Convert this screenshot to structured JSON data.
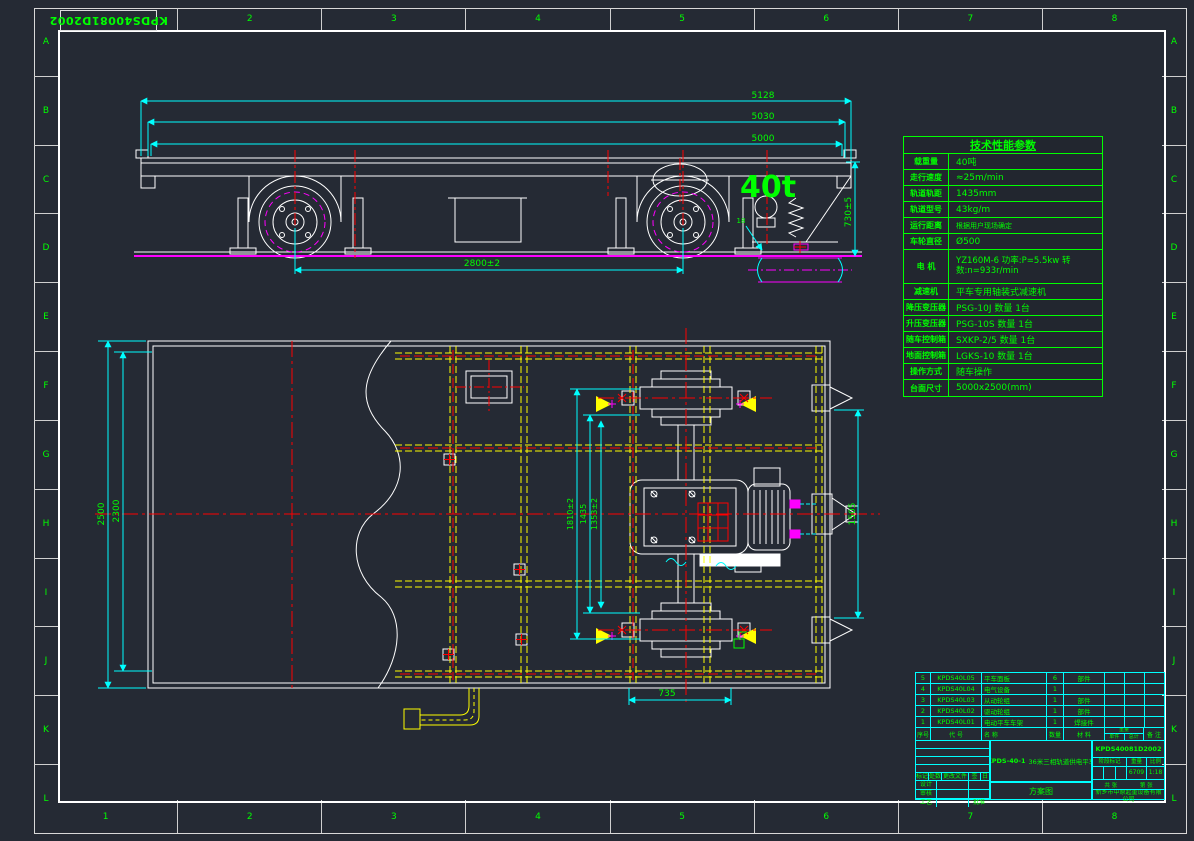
{
  "frame": {
    "corner_code": "KPDS40081D2002",
    "zones_numbers": [
      "1",
      "2",
      "3",
      "4",
      "5",
      "6",
      "7",
      "8"
    ],
    "zones_letters": [
      "A",
      "B",
      "C",
      "D",
      "E",
      "F",
      "G",
      "H",
      "I",
      "J",
      "K",
      "L"
    ]
  },
  "side_view": {
    "load": "40t",
    "dim_total": "5128",
    "dim_mid": "5030",
    "dim_deck": "5000",
    "dim_wheelbase": "2800±2",
    "dim_height": "730±5",
    "dim_rail": "18"
  },
  "plan_view": {
    "dim_width": "2500",
    "dim_width_inner": "2300",
    "dim_outer": "1810±2",
    "dim_gauge": "1435",
    "dim_inner": "1353±2",
    "dim_side": "1505",
    "dim_bottom": "735"
  },
  "tech_table": {
    "title": "技术性能参数",
    "rows": [
      {
        "label": "载重量",
        "value": "40吨"
      },
      {
        "label": "走行速度",
        "value": "≈25m/min"
      },
      {
        "label": "轨道轨距",
        "value": "1435mm"
      },
      {
        "label": "轨道型号",
        "value": "43kg/m"
      },
      {
        "label": "运行距离",
        "value": "根据用户现场确定"
      },
      {
        "label": "车轮直径",
        "value": "Ø500"
      },
      {
        "label": "电  机",
        "value": "YZ160M-6 功率:P=5.5kw 转数:n=933r/min"
      },
      {
        "label": "减速机",
        "value": "平车专用轴装式减速机"
      },
      {
        "label": "降压变压器",
        "value": "PSG-10J  数量 1台"
      },
      {
        "label": "升压变压器",
        "value": "PSG-10S  数量 1台"
      },
      {
        "label": "随车控制箱",
        "value": "SXKP-2/5  数量 1台"
      },
      {
        "label": "地面控制箱",
        "value": "LGKS-10  数量 1台"
      },
      {
        "label": "操作方式",
        "value": "随车操作"
      },
      {
        "label": "台面尺寸",
        "value": "5000x2500(mm)"
      }
    ]
  },
  "bom": {
    "headers": {
      "no": "序号",
      "code": "代 号",
      "name": "名 称",
      "qty": "数量",
      "material": "材 料",
      "weight": "重量",
      "unit": "单件",
      "total": "总计",
      "note": "备 注"
    },
    "rows": [
      {
        "no": "5",
        "code": "KPDS40L05",
        "name": "平车面板",
        "qty": "6",
        "material": "部件",
        "w1": "",
        "w2": "",
        "note": ""
      },
      {
        "no": "4",
        "code": "KPDS40L04",
        "name": "电气设备",
        "qty": "1",
        "material": "",
        "w1": "",
        "w2": "",
        "note": ""
      },
      {
        "no": "3",
        "code": "KPDS40L03",
        "name": "从动轮组",
        "qty": "1",
        "material": "部件",
        "w1": "",
        "w2": "",
        "note": ""
      },
      {
        "no": "2",
        "code": "KPDS40L02",
        "name": "驱动轮组",
        "qty": "1",
        "material": "部件",
        "w1": "",
        "w2": "",
        "note": ""
      },
      {
        "no": "1",
        "code": "KPDS40L01",
        "name": "电动平车车架",
        "qty": "1",
        "material": "焊接件",
        "w1": "",
        "w2": "",
        "note": ""
      }
    ]
  },
  "title_block": {
    "drawing_no": "KPDS40081D2002",
    "model": "KPDS-40-1",
    "title": "36米三相轨道供电平车",
    "scheme": "方案图",
    "company": "新乡市中原起重设备有限公司",
    "stage_label": "阶段标记",
    "weight_label": "重量",
    "scale_label": "比例",
    "weight_value": "6709",
    "scale_value": "1:18",
    "sheet_total": "共 张",
    "sheet_index": "第 张",
    "sig": {
      "mark": "标记",
      "count": "处数",
      "doc": "更改文件号",
      "sign": "签名",
      "date": "日期",
      "design": "设计",
      "check": "审核",
      "craft": "工艺",
      "approve": "批准"
    }
  }
}
